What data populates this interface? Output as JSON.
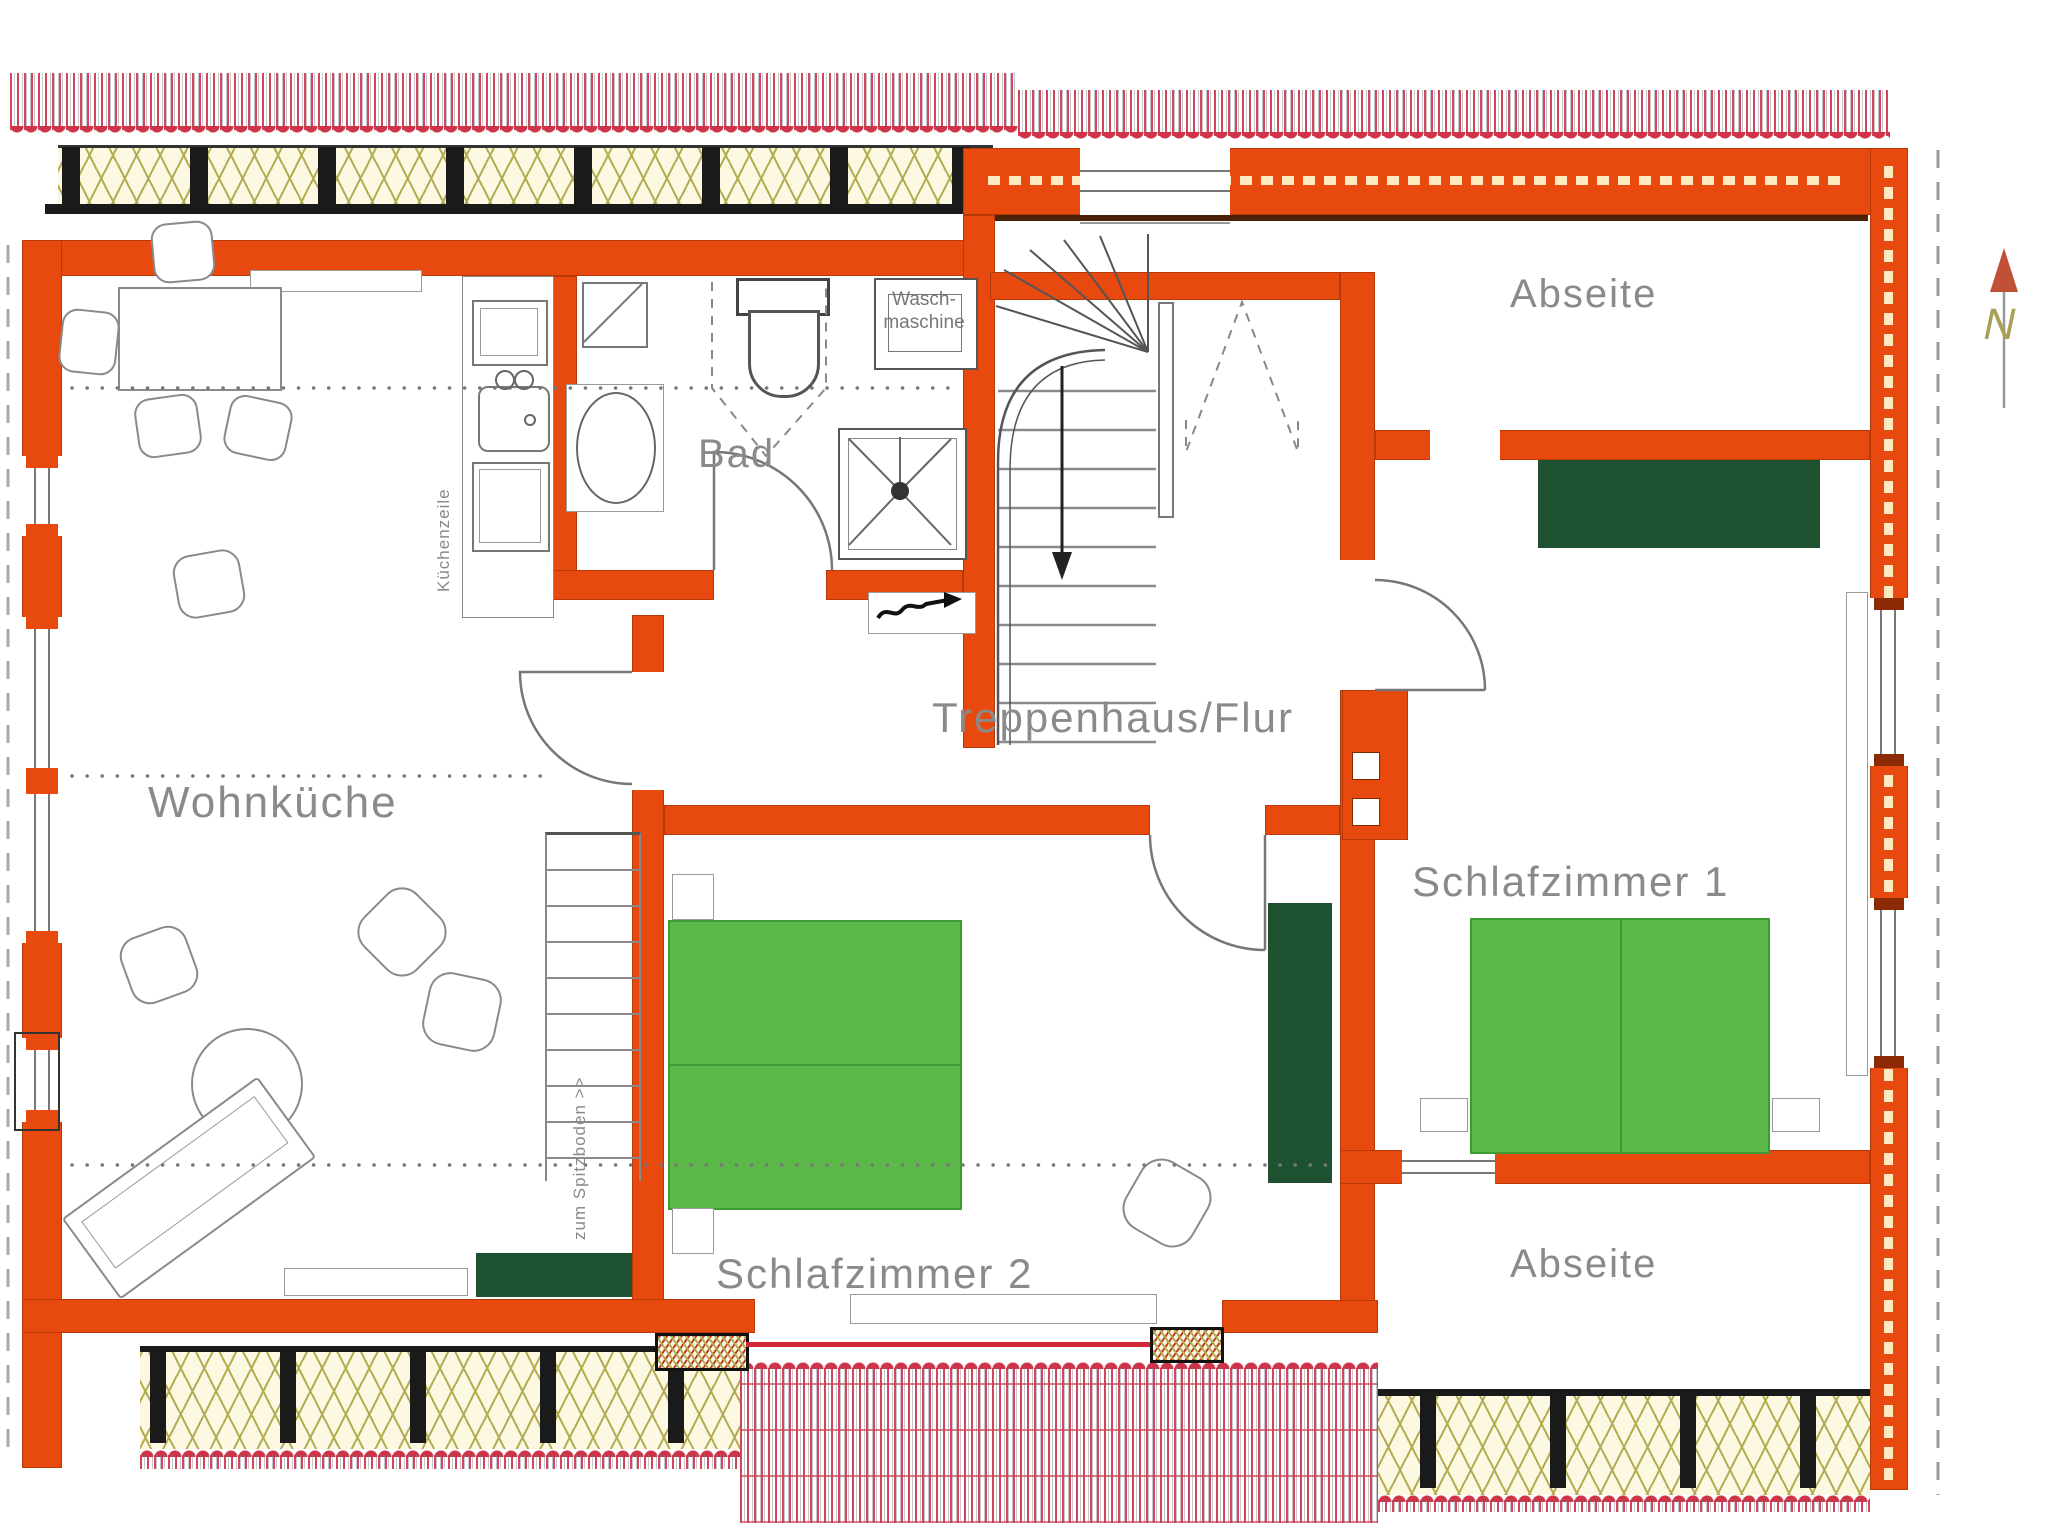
{
  "rooms": {
    "wohnkueche": {
      "label": "Wohnküche"
    },
    "bad": {
      "label": "Bad"
    },
    "flur": {
      "label": "Treppenhaus/Flur"
    },
    "schlafzimmer1": {
      "label": "Schlafzimmer 1"
    },
    "schlafzimmer2": {
      "label": "Schlafzimmer 2"
    },
    "abseite_top": {
      "label": "Abseite"
    },
    "abseite_bottom": {
      "label": "Abseite"
    }
  },
  "annotations": {
    "waschmaschine_line1": "Wasch-",
    "waschmaschine_line2": "maschine",
    "kuechenzeile": "Küchenzeile",
    "spitzboden": "zum Spitzboden >>",
    "north": "N"
  },
  "colors": {
    "wall_orange": "#e8490f",
    "bed_green": "#5cb848",
    "wardrobe_green": "#1d5130",
    "roof_red": "#cf3347",
    "insulation_olive": "#b3ad52",
    "label_gray": "#8a8a8a"
  }
}
